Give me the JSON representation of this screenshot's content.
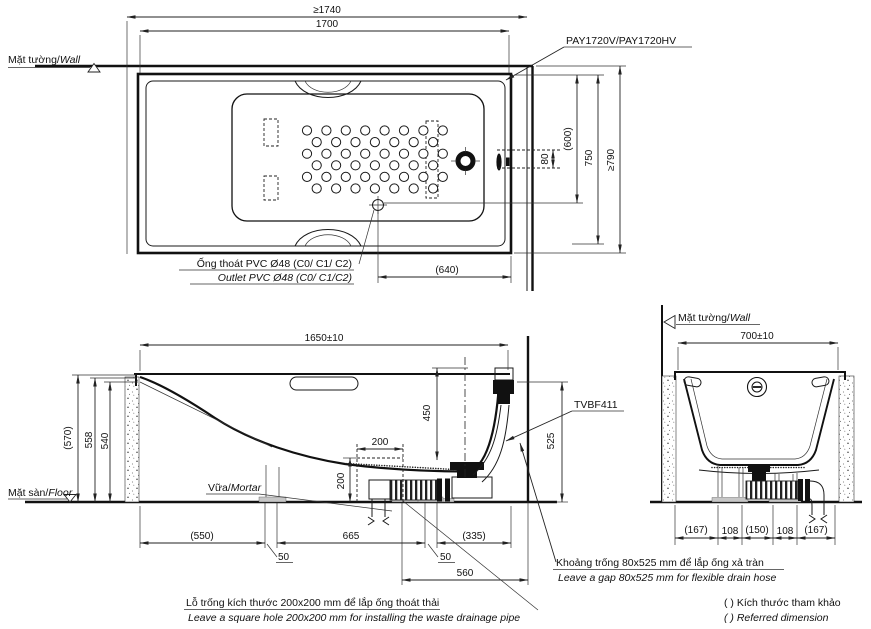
{
  "drawing": {
    "plan": {
      "wall_label": {
        "vi": "Mặt tường/",
        "en": "Wall"
      },
      "model": "PAY1720V/PAY1720HV",
      "dims": {
        "niche_width": "≥1740",
        "tub_length": "1700",
        "overflow_offset": "80",
        "outlet_from_wall": "(600)",
        "tub_width": "750",
        "niche_depth": "≥790",
        "outlet_from_end": "(640)"
      },
      "outlet_note": {
        "vi": "Ống thoát PVC Ø48 (C0/ C1/ C2)",
        "en": "Outlet PVC Ø48 (C0/ C1/C2)"
      }
    },
    "section": {
      "dims": {
        "length": "1650±10",
        "h570": "(570)",
        "h558": "558",
        "h540": "540",
        "h450": "450",
        "h525": "525",
        "hole_w": "200",
        "hole_h": "200",
        "d550": "(550)",
        "d50l": "50",
        "d665": "665",
        "d50r": "50",
        "d335": "(335)",
        "d560": "560"
      },
      "floor_label": {
        "vi": "Mặt sàn/",
        "en": "Floor"
      },
      "mortar_label": {
        "vi": "Vữa/",
        "en": "Mortar"
      },
      "drain_model": "TVBF411"
    },
    "end": {
      "wall_label": {
        "vi": "Mặt tường/",
        "en": "Wall"
      },
      "dims": {
        "width": "700±10",
        "bottom": [
          "(167)",
          "108",
          "(150)",
          "108",
          "(167)"
        ]
      }
    },
    "notes": {
      "gap": {
        "vi": "Khoảng trống 80x525 mm để lắp ống xả tràn",
        "en": "Leave a gap 80x525 mm for flexible drain hose"
      },
      "hole": {
        "vi": "Lỗ trống kích thước 200x200 mm để lắp ống thoát thải",
        "en": "Leave a square hole  200x200 mm for installing the waste drainage pipe"
      },
      "legend": {
        "vi": "(      ) Kích thước tham khảo",
        "en": "(      ) Referred dimension"
      }
    }
  }
}
